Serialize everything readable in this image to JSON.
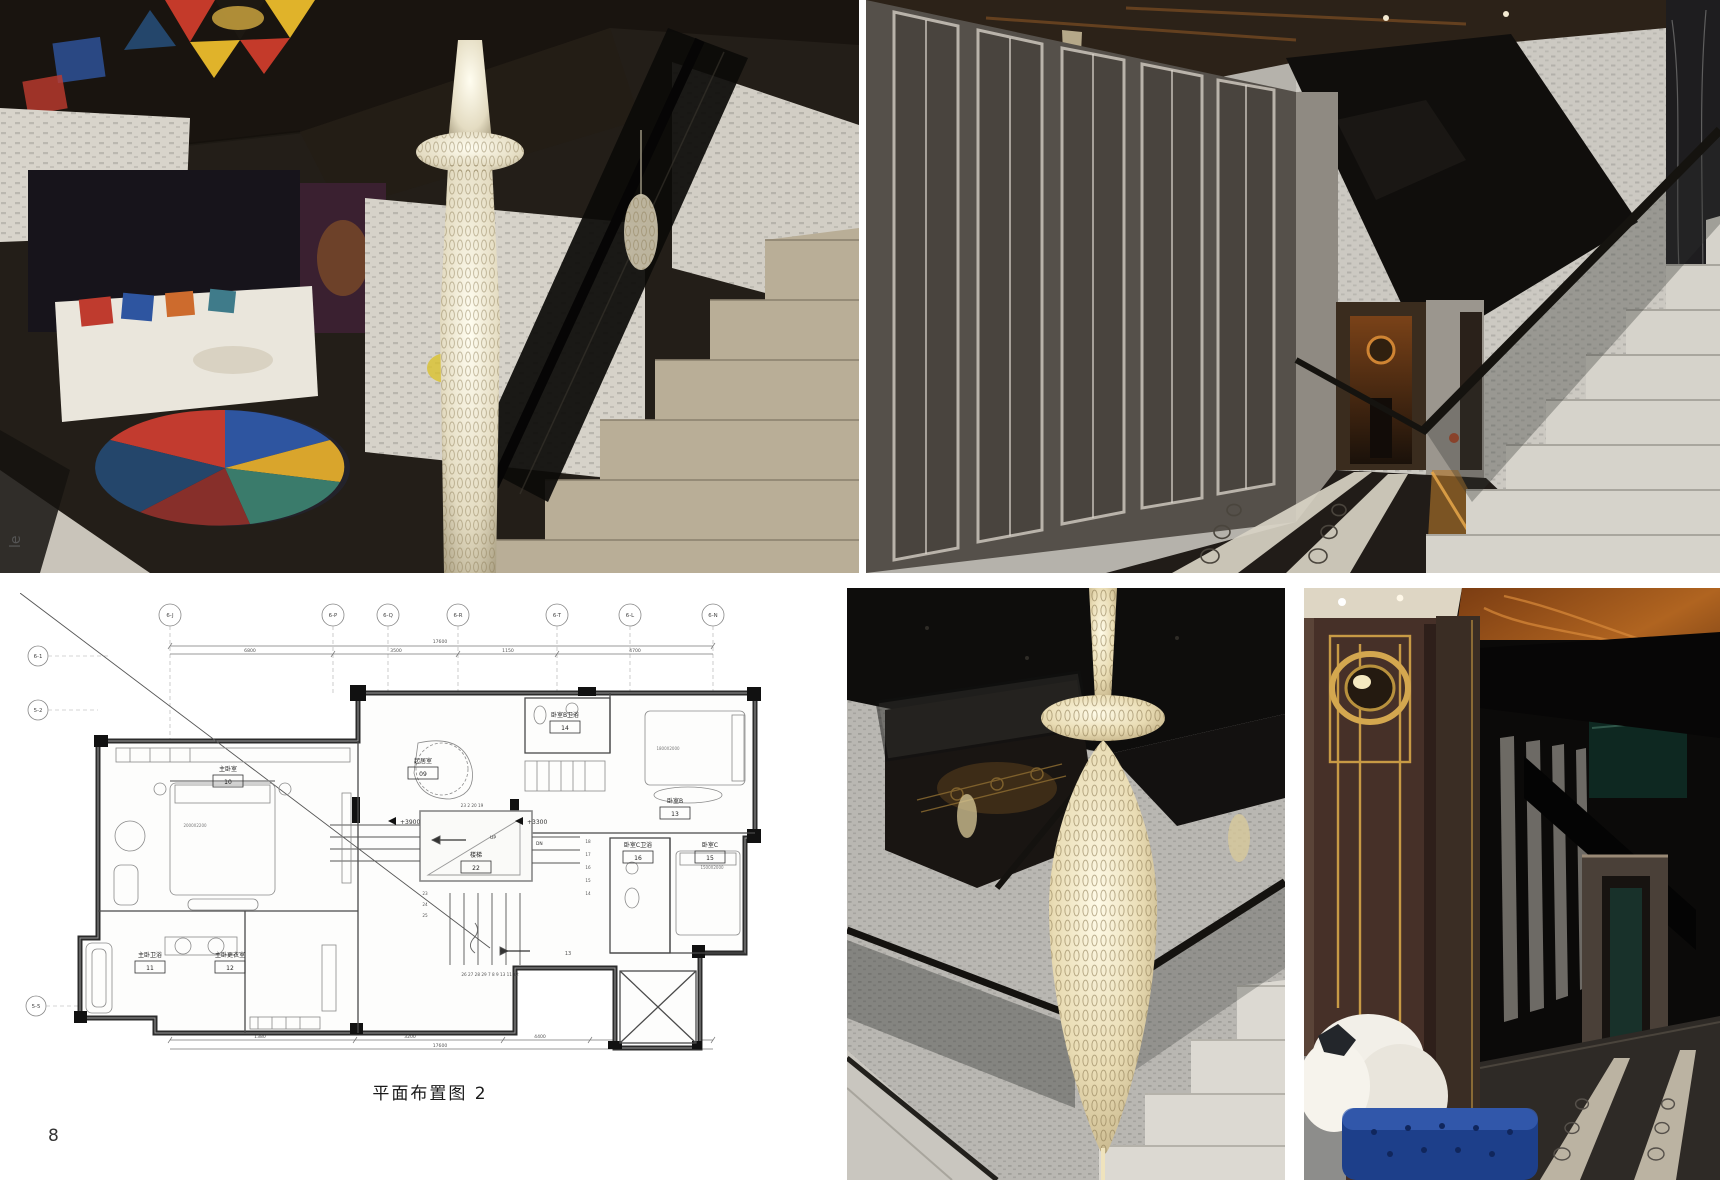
{
  "page": {
    "number": "8",
    "side_text": "le"
  },
  "palette": {
    "page_bg": "#ffffff",
    "plan_line": "#1a1a1a",
    "marble_beige": "#b9ae97",
    "stair_white": "#d6d3cb",
    "ottoman_blue": "#1d3f8a",
    "amber_mirror": "#b06420",
    "gold_trim": "#c79a45"
  },
  "floor_plan": {
    "caption": "平面布置图 2",
    "grid_bubbles_top": [
      "6-J",
      "6-P",
      "6-Q",
      "6-R",
      "6-T",
      "6-L",
      "6-N"
    ],
    "grid_bubbles_left": [
      "6-1",
      "5-2",
      "5-5"
    ],
    "dim_total_top": "17600",
    "dim_segments_top": [
      "6800",
      "3500",
      "1150",
      "4700"
    ],
    "dim_total_bottom": "17600",
    "dim_segments_bottom": [
      "1380",
      "3200",
      "4400",
      "1470",
      "3770"
    ],
    "level_left": "+3900",
    "level_right": "+3300",
    "up_label": "UP",
    "dn_label": "DN",
    "rooms": [
      {
        "name": "主卧室",
        "no": "10"
      },
      {
        "name": "主卧卫浴",
        "no": "11"
      },
      {
        "name": "主卧更衣室",
        "no": "12"
      },
      {
        "name": "起居室",
        "no": "09"
      },
      {
        "name": "卧室B卫浴",
        "no": "14"
      },
      {
        "name": "卧室B",
        "no": "13"
      },
      {
        "name": "卧室C卫浴",
        "no": "16"
      },
      {
        "name": "卧室C",
        "no": "15"
      },
      {
        "name": "楼梯",
        "no": "22"
      }
    ],
    "bed_sizes": [
      "2000X2200",
      "1800X2000",
      "1500X2000"
    ],
    "stair_top_numbers": "23  2  20  19",
    "stair_bottom_numbers": "26 27 28 29 7 8 9 13 11 12",
    "stair_left_numbers": [
      "23",
      "24",
      "25"
    ],
    "stair_right_numbers": [
      "18",
      "17",
      "16",
      "15",
      "14"
    ],
    "stair_landing_number": "13"
  }
}
